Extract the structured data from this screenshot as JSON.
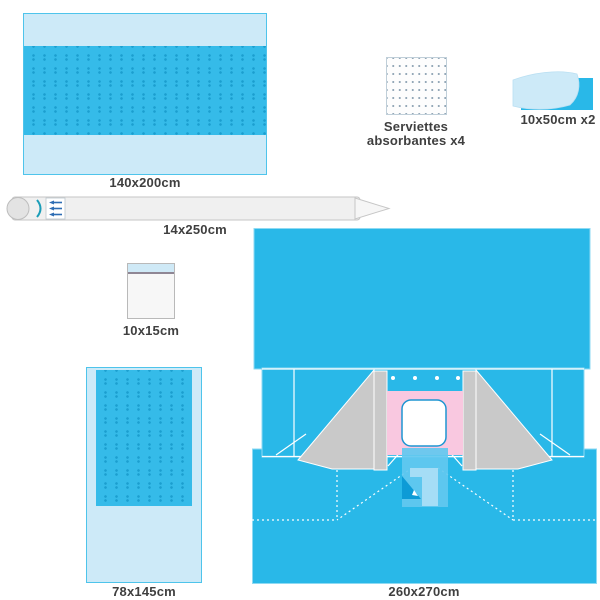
{
  "title": "surgical-pack-contents-diagram",
  "items": {
    "drape_140": {
      "label": "140x200cm"
    },
    "towels": {
      "label_line1": "Serviettes",
      "label_line2": "absorbantes x4"
    },
    "tape": {
      "label": "10x50cm x2"
    },
    "instrument_cover": {
      "label": "14x250cm"
    },
    "bag": {
      "label": "10x15cm"
    },
    "drape_78": {
      "label": "78x145cm"
    },
    "main_drape": {
      "label": "260x270cm"
    }
  },
  "colors": {
    "blue": "#29b8e8",
    "light_blue": "#cdeaf8",
    "band_blue": "#35bbe9",
    "dot_blue": "#1b9ecf",
    "gray": "#c9c9c9",
    "pink": "#f9c8e0",
    "pouch_blue": "#62c8ef",
    "pouch_fold": "#0d9bd6",
    "label_text": "#3f3f3f"
  }
}
